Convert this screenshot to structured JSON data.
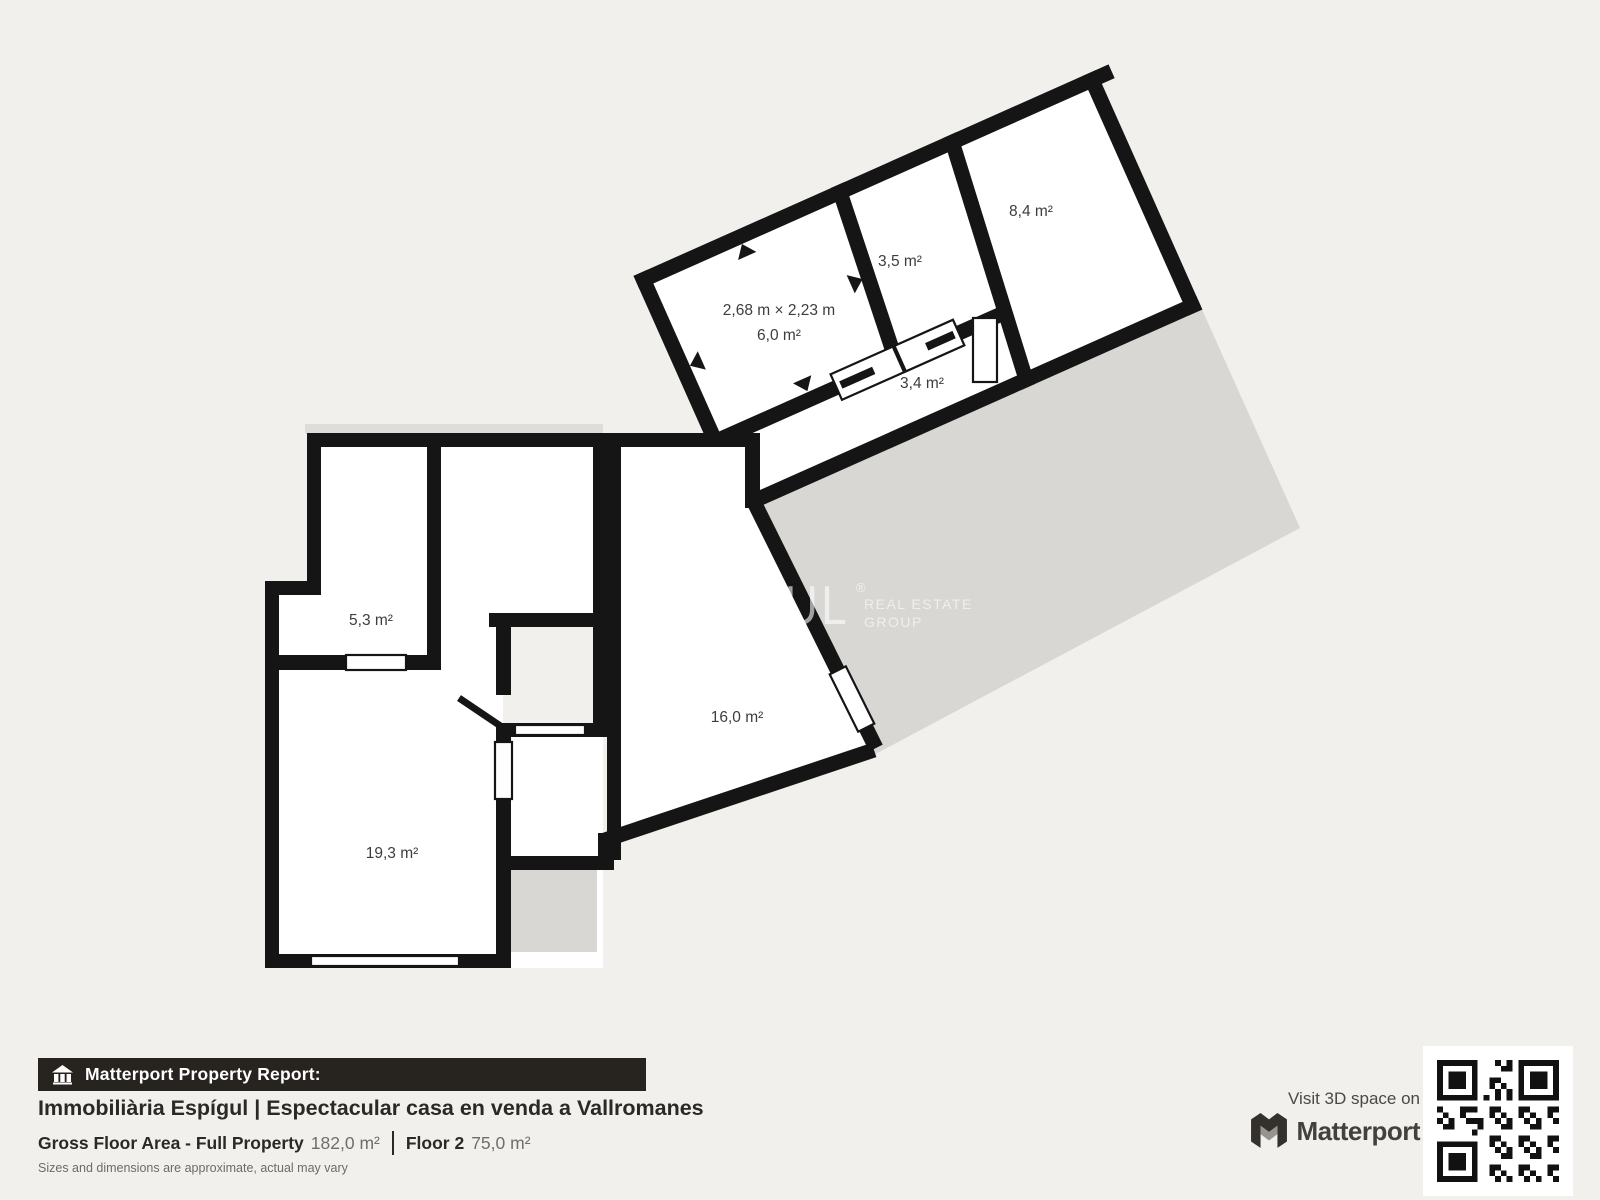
{
  "plan": {
    "rooms": {
      "r84": {
        "label": "8,4 m²"
      },
      "r35": {
        "label": "3,5 m²"
      },
      "r60": {
        "dims": "2,68 m × 2,23 m",
        "label": "6,0 m²"
      },
      "r34": {
        "label": "3,4 m²"
      },
      "r53": {
        "label": "5,3 m²"
      },
      "r160": {
        "label": "16,0 m²"
      },
      "r193": {
        "label": "19,3 m²"
      }
    },
    "watermark": {
      "brand": "ESPÍGUL",
      "reg": "®",
      "sub1": "REAL ESTATE",
      "sub2": "GROUP"
    },
    "colors": {
      "wall": "#151515",
      "floor": "#ffffff",
      "terrace": "#d8d7d4",
      "background": "#f1f0ec"
    }
  },
  "footer": {
    "report_bar": {
      "icon": "house-icon",
      "label": "Matterport Property Report:"
    },
    "title": "Immobiliària Espígul | Espectacular casa en venda a Vallromanes",
    "gross_area_label": "Gross Floor Area - Full Property",
    "gross_area_value": "182,0 m²",
    "floor_label": "Floor 2",
    "floor_value": "75,0 m²",
    "disclaimer": "Sizes and dimensions are approximate, actual may vary"
  },
  "branding": {
    "visit_text": "Visit 3D space on",
    "logo_text": "Matterport",
    "logo_icon": "matterport-m-icon",
    "qr": "qr-code"
  }
}
